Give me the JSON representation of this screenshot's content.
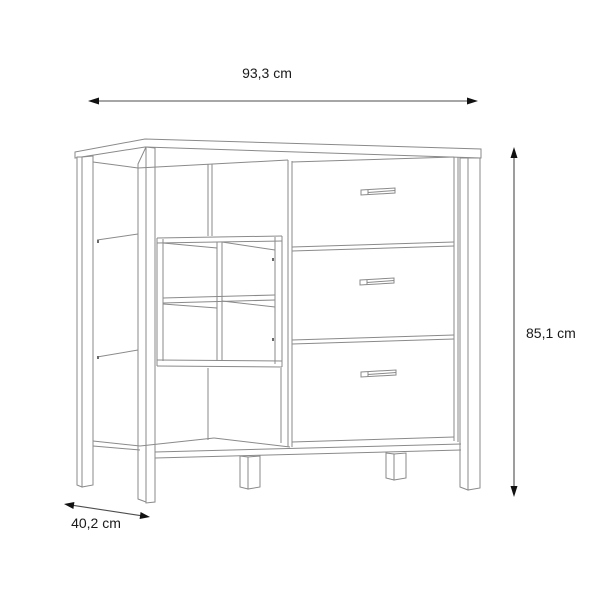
{
  "diagram": {
    "type": "product-dimension-line-drawing",
    "subject": "sideboard with open shelves, 2x2 cube insert and three drawers",
    "dimensions": {
      "width_label": "93,3 cm",
      "height_label": "85,1 cm",
      "depth_label": "40,2 cm"
    },
    "colors": {
      "background": "#ffffff",
      "outline": "#8a8a8a",
      "dimension_line": "#4d4d4d",
      "arrowhead": "#111111",
      "label_text": "#1a1a1a"
    }
  }
}
